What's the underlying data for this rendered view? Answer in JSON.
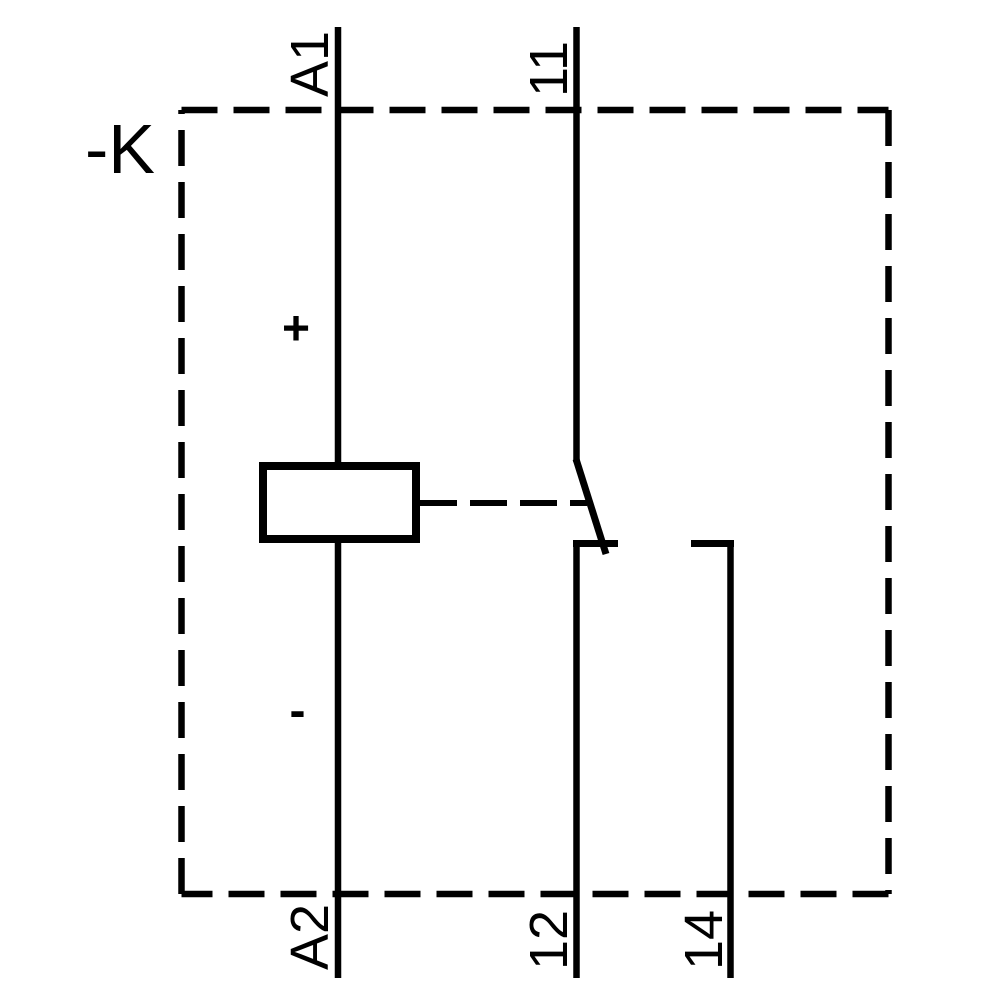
{
  "schematic": {
    "device_designation": "-K",
    "coil": {
      "terminal_top": "A1",
      "terminal_bottom": "A2",
      "polarity_positive": "+",
      "polarity_negative": "-"
    },
    "contact": {
      "terminal_common": "11",
      "terminal_nc": "12",
      "terminal_no": "14"
    },
    "colors": {
      "line": "#000000",
      "text": "#000000",
      "background": "#ffffff"
    }
  }
}
